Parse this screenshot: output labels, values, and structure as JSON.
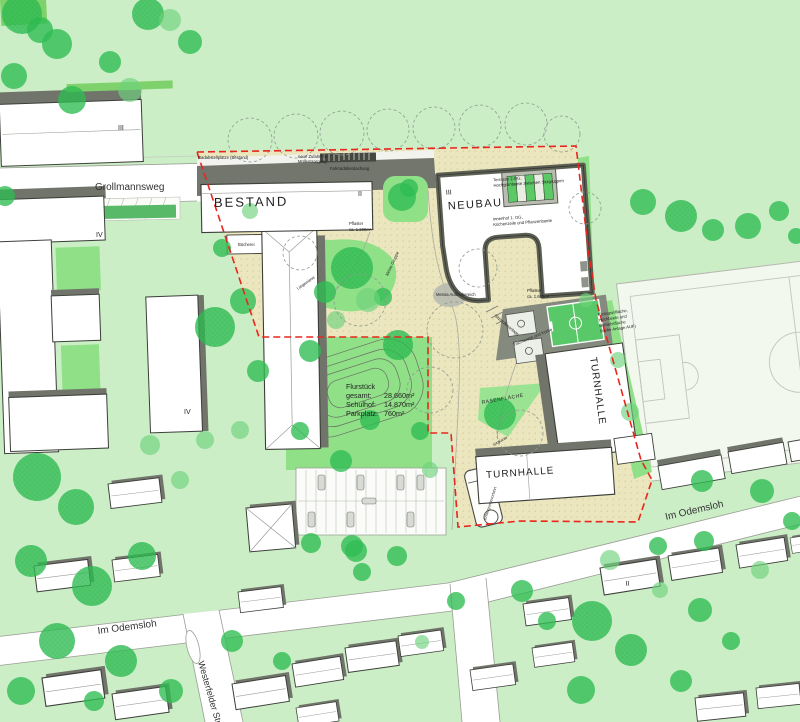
{
  "labels": {
    "bestand": "BESTAND",
    "neubau": "NEUBAU",
    "turnhalle": "TURNHALLE",
    "grollmannsweg": "Grollmannsweg",
    "im_odemsloh": "Im Odemsloh",
    "westerfelder": "Westerfelder Str.",
    "rasenflaeche": "RASENFLÄCHE",
    "mensa": "Mensa Außenbereich",
    "sitzstufen": "Sitzstufenanlage",
    "terrasse_1": "Terrasse 2.OG,",
    "terrasse_2": "Hochgrünbeete zwischen Sitzgruppen",
    "innenhof_1": "Innenhof 1. OG,",
    "innenhof_2": "Küchenzeile und Pflanzenbeete",
    "kleinspiel_1": "Kleinspielfläche,",
    "kleinspiel_2": "Hochbeete und",
    "kleinspiel_3": "Betriebsfläche",
    "kleinspiel_4": "(siehe Anlage AUF)",
    "pflaster": "Pflaster",
    "pflaster_west_wert": "ca. 1.200m²",
    "pflaster_ost_wert": "ca. 1.600m²",
    "radabstell": "Radabstellplätze (Bestand)",
    "zufahrt_1": "neue Zufahrt für",
    "zufahrt_2": "Müllentsorgung",
    "fahrrad": "Fahrradüberdachung",
    "tischtennis": "Tischtennis und Körbe",
    "liegewiese": "Liegewiese",
    "kleine_gruppe": "kleine Gruppe",
    "buecherei": "Bücherei",
    "sitzkante": "Sitzkante",
    "entsorgung": "Entsorgungsvorfahrt",
    "floor_two": "II",
    "floor_three": "III",
    "floor_four": "IV"
  },
  "flurstueck": {
    "heading": "Flurstück",
    "rows": [
      {
        "label": "gesamt:",
        "value": "28.660m²"
      },
      {
        "label": "Schulhof:",
        "value": "14.870m²"
      },
      {
        "label": "Parkplatz:",
        "value": "760m²"
      }
    ]
  },
  "colors": {
    "lawn": "#cbeec6",
    "play_lawn": "#8fe087",
    "schoolyard_beige": "#ebe6bd",
    "tree_green": "#2ebd52",
    "boundary_red": "#e8261d",
    "building_shadow": "#70746a",
    "court_green": "#58c868"
  }
}
